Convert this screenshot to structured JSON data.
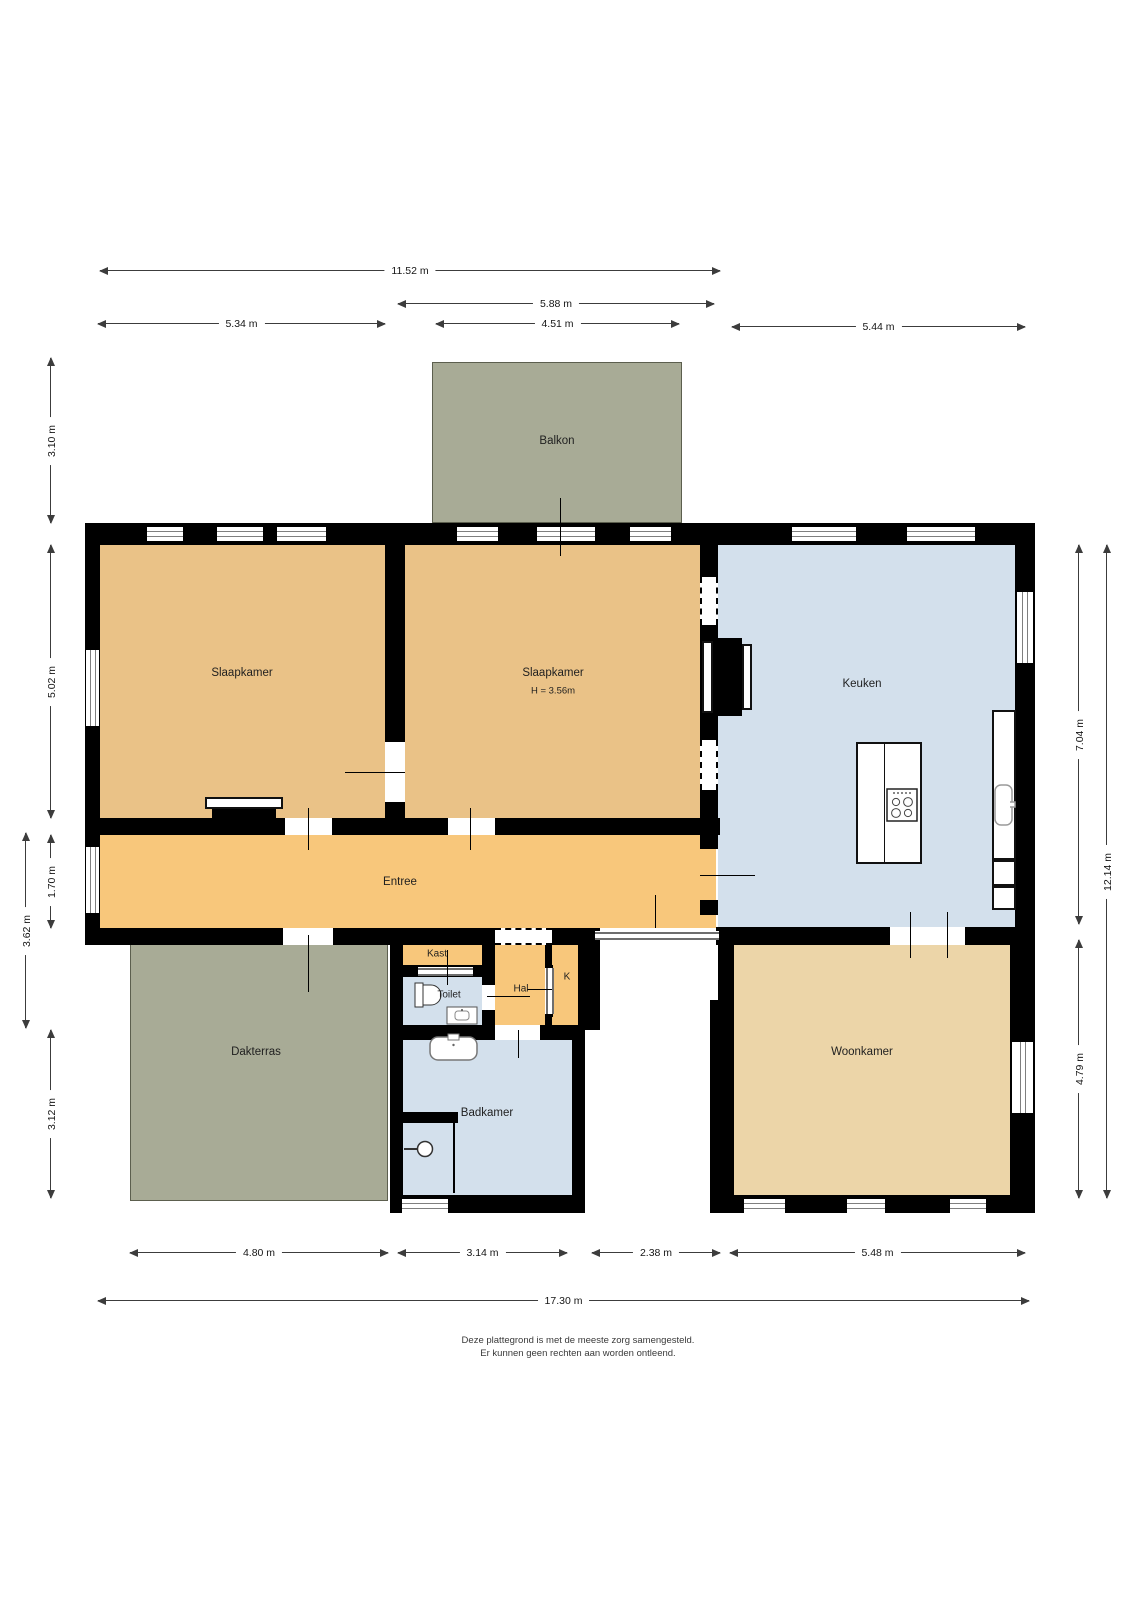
{
  "rooms": {
    "balkon": {
      "label": "Balkon"
    },
    "slaapkamer1": {
      "label": "Slaapkamer"
    },
    "slaapkamer2": {
      "label": "Slaapkamer",
      "height_note": "H = 3.56m"
    },
    "keuken": {
      "label": "Keuken"
    },
    "entree": {
      "label": "Entree"
    },
    "kast": {
      "label": "Kast"
    },
    "toilet": {
      "label": "Toilet"
    },
    "hal": {
      "label": "Hal"
    },
    "k": {
      "label": "K"
    },
    "dakterras": {
      "label": "Dakterras"
    },
    "badkamer": {
      "label": "Badkamer"
    },
    "woonkamer": {
      "label": "Woonkamer"
    }
  },
  "dimensions": {
    "top_total": "11.52 m",
    "top_mid": "5.88 m",
    "top_bed1": "5.34 m",
    "top_balkon": "4.51 m",
    "top_keuken": "5.44 m",
    "left_balkon": "3.10 m",
    "left_bed": "5.02 m",
    "left_entree": "1.70 m",
    "left_mid": "3.62 m",
    "left_terras": "3.12 m",
    "right_keuken": "7.04 m",
    "right_total": "12.14 m",
    "right_woonkamer": "4.79 m",
    "bottom_terras": "4.80 m",
    "bottom_badkamer": "3.14 m",
    "bottom_notch": "2.38 m",
    "bottom_woonkamer": "5.48 m",
    "bottom_total": "17.30 m"
  },
  "disclaimer": {
    "line1": "Deze plattegrond is met de meeste zorg samengesteld.",
    "line2": "Er kunnen geen rechten aan worden ontleend."
  },
  "fixtures": [
    "stove-icon",
    "kitchen-sink-icon",
    "toilet-icon",
    "toilet-sink-icon",
    "bath-sink-icon",
    "shower-icon"
  ],
  "colors": {
    "bedroom_fill": "#eac287",
    "entree_fill": "#f8c77b",
    "living_fill": "#ecd5a8",
    "wet_room_fill": "#d3e0ec",
    "outdoor_fill": "#a8ab96",
    "wall": "#000000",
    "dimension_line": "#3c3c3c"
  }
}
